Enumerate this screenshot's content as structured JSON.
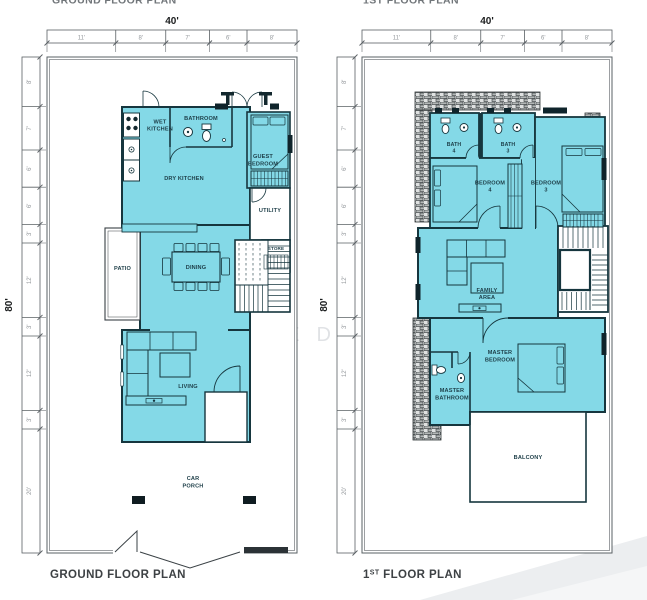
{
  "header": {
    "left_cropped_title": "GROUND FLOOR PLAN",
    "right_cropped_title": "1ST FLOOR PLAN"
  },
  "watermark": {
    "text": "BYD RED HE"
  },
  "colors": {
    "room_fill": "#84d9e7",
    "wall": "#16363e",
    "dim_text": "#95999d",
    "title_text": "#3d4144"
  },
  "ground_floor": {
    "title": "GROUND FLOOR PLAN",
    "total_width": "40'",
    "total_height": "80'",
    "top_dims": [
      "11'",
      "8'",
      "7'",
      "6'",
      "8'"
    ],
    "left_dims": [
      "8'",
      "7'",
      "6'",
      "6'",
      "3'",
      "12'",
      "3'",
      "12'",
      "3'",
      "20'"
    ],
    "rooms": {
      "wet_kitchen_1": "WET",
      "wet_kitchen_2": "KITCHEN",
      "bathroom": "BATHROOM",
      "dry_kitchen": "DRY KITCHEN",
      "guest_bedroom_1": "GUEST",
      "guest_bedroom_2": "BEDROOM",
      "utility": "UTILITY",
      "store": "STORE",
      "patio": "PATIO",
      "dining": "DINING",
      "living": "LIVING",
      "car_porch_1": "CAR",
      "car_porch_2": "PORCH"
    }
  },
  "first_floor": {
    "title_prefix": "1",
    "title_sup": "ST",
    "title_rest": " FLOOR PLAN",
    "total_width": "40'",
    "total_height": "80'",
    "top_dims": [
      "11'",
      "8'",
      "7'",
      "6'",
      "8'"
    ],
    "left_dims": [
      "8'",
      "7'",
      "6'",
      "6'",
      "3'",
      "12'",
      "3'",
      "12'",
      "3'",
      "20'"
    ],
    "rooms": {
      "bath4_1": "BATH",
      "bath4_2": "4",
      "bath3_1": "BATH",
      "bath3_2": "3",
      "bedroom4_1": "BEDROOM",
      "bedroom4_2": "4",
      "bedroom3_1": "BEDROOM",
      "bedroom3_2": "3",
      "family_1": "FAMILY",
      "family_2": "AREA",
      "master_bedroom_1": "MASTER",
      "master_bedroom_2": "BEDROOM",
      "master_bathroom_1": "MASTER",
      "master_bathroom_2": "BATHROOM",
      "balcony": "BALCONY"
    }
  }
}
